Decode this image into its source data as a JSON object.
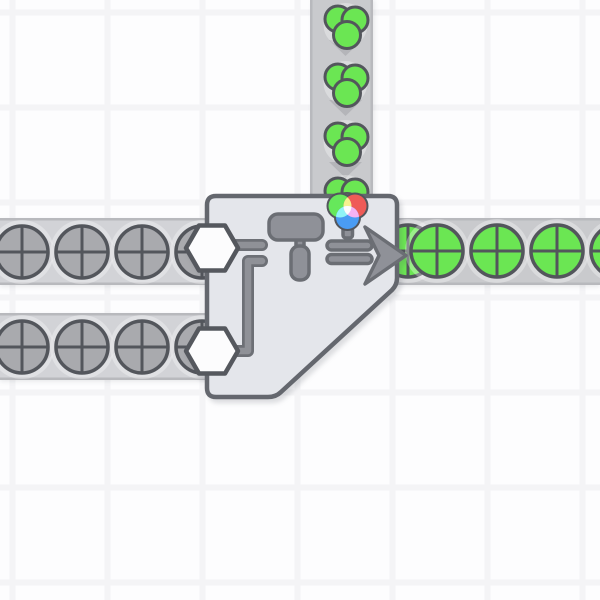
{
  "scene": {
    "kind": "factory-game-viewport",
    "description": "conveyor network feeding a double painter building",
    "canvas_size": {
      "width": 600,
      "height": 600
    }
  },
  "colors": {
    "page_bg": "#fdfdfe",
    "grid_line": "#f4f4f6",
    "belt_light": "#d2d3d7",
    "belt_mid": "#c9cacd",
    "belt_edge": "#b8b9bd",
    "chevron": "#b4b5b9",
    "halo": "rgba(255,255,255,0.32)",
    "item_outline": "#53565c",
    "item_gray": "#a9aaae",
    "item_green": "#6be653",
    "building_fill": "#e4e6eb",
    "building_border": "#64676e",
    "hex_fill": "#fcfcfd",
    "hex_stroke": "#55585e",
    "icon_fill": "#8f9198",
    "icon_stroke": "#6b6e74",
    "wire_core": "#8f9197",
    "wire_outline": "#6d7076",
    "wheel_red": "#ef5b57",
    "wheel_green": "#66e85b",
    "wheel_blue": "#4a9cf3",
    "wheel_yellow": "#f5f18f",
    "wheel_cyan": "#90f4f6",
    "wheel_magenta": "#f5b2f3",
    "wheel_center": "#fdfdfd"
  },
  "legend": {
    "gray-circle": "uncolored circle shape item (4 quadrants)",
    "green-circle": "green painted circle shape item",
    "green-color-blob": "green color item (3 overlapping dots)"
  },
  "belts": [
    {
      "id": "left-top",
      "direction": "right",
      "shade": "light",
      "x": 0,
      "y": 218,
      "w": 212,
      "h": 67,
      "item": "gray-circle",
      "item_cy": 252,
      "item_cx": [
        22,
        82,
        142,
        202
      ],
      "chevrons_x": [
        44,
        104,
        164
      ]
    },
    {
      "id": "left-bottom",
      "direction": "right",
      "shade": "light",
      "x": 0,
      "y": 313,
      "w": 212,
      "h": 67,
      "item": "gray-circle",
      "item_cy": 347,
      "item_cx": [
        22,
        82,
        142,
        202
      ],
      "chevrons_x": [
        44,
        104,
        164
      ]
    },
    {
      "id": "right-output",
      "direction": "right",
      "shade": "mid",
      "x": 395,
      "y": 218,
      "w": 205,
      "h": 67,
      "item": "green-circle",
      "item_cy": 251,
      "item_cx": [
        408,
        437,
        497,
        557,
        617
      ],
      "chevrons_x": [
        459,
        519,
        579
      ]
    },
    {
      "id": "top-color-input",
      "direction": "down",
      "shade": "mid",
      "x": 310,
      "y": 0,
      "w": 63,
      "h": 200,
      "item": "green-color-blob",
      "item_cx": 345.5,
      "item_cy": [
        25,
        83,
        142,
        197
      ],
      "chevrons_y": [
        40,
        100,
        162
      ]
    }
  ],
  "building": {
    "name": "double-painter",
    "icons": [
      "paint-roller-icon",
      "output-arrow-icon",
      "rgb-color-wheel-icon"
    ],
    "shape_inputs": 2,
    "color_input_side": "top",
    "output_side": "right",
    "current_color": "green"
  }
}
